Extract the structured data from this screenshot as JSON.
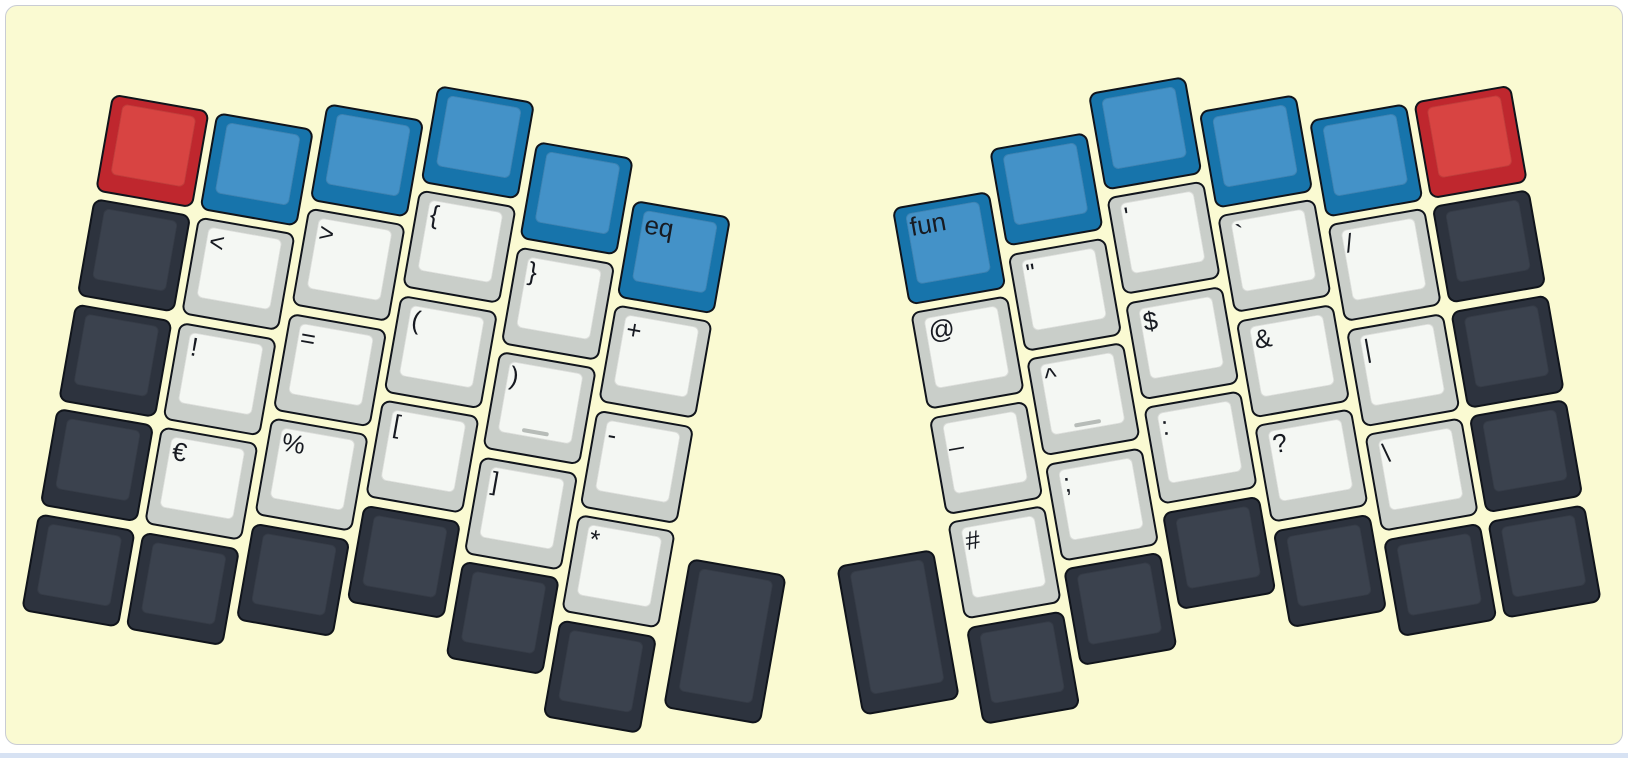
{
  "page": {
    "background": "#ffffff",
    "bottom_strip_color": "#d7e2f3"
  },
  "canvas": {
    "background": "#fafad2",
    "border_color": "#c9ccd4"
  },
  "palette": {
    "outline": "#10141b",
    "legend": "#171a21",
    "homing_bar": "#b7bcb8",
    "red": {
      "side": "#bf272e",
      "top": "#d84442"
    },
    "blue": {
      "side": "#1774ab",
      "top": "#4492c8"
    },
    "dark": {
      "side": "#2d333e",
      "top": "#3b424e"
    },
    "light": {
      "side": "#c9cec9",
      "top": "#f4f7f3"
    }
  },
  "geometry": {
    "unit_px": 106.5,
    "key_size_px": 99,
    "key_inset_px": 3.75
  },
  "halves": {
    "left": {
      "name": "left-hand",
      "rotation_deg": 10,
      "origin": {
        "x": 103,
        "y": 83
      },
      "mirrored": false,
      "columns": [
        {
          "stagger_px": 0,
          "keys": [
            {
              "color": "red",
              "label": ""
            },
            {
              "color": "dark",
              "label": ""
            },
            {
              "color": "dark",
              "label": ""
            },
            {
              "color": "dark",
              "label": ""
            },
            {
              "color": "dark",
              "label": ""
            }
          ]
        },
        {
          "stagger_px": 0,
          "keys": [
            {
              "color": "blue",
              "label": ""
            },
            {
              "color": "light",
              "label": "<"
            },
            {
              "color": "light",
              "label": "!"
            },
            {
              "color": "light",
              "label": "€"
            },
            {
              "color": "dark",
              "label": ""
            }
          ]
        },
        {
          "stagger_px": -28,
          "keys": [
            {
              "color": "blue",
              "label": ""
            },
            {
              "color": "light",
              "label": ">"
            },
            {
              "color": "light",
              "label": "="
            },
            {
              "color": "light",
              "label": "%"
            },
            {
              "color": "dark",
              "label": ""
            }
          ]
        },
        {
          "stagger_px": -65,
          "keys": [
            {
              "color": "blue",
              "label": ""
            },
            {
              "color": "light",
              "label": "{"
            },
            {
              "color": "light",
              "label": "("
            },
            {
              "color": "light",
              "label": "["
            },
            {
              "color": "dark",
              "label": ""
            }
          ]
        },
        {
          "stagger_px": -26.5,
          "keys": [
            {
              "color": "blue",
              "label": ""
            },
            {
              "color": "light",
              "label": "}"
            },
            {
              "color": "light",
              "label": ")",
              "homing": true
            },
            {
              "color": "light",
              "label": "]"
            },
            {
              "color": "dark",
              "label": ""
            }
          ]
        },
        {
          "stagger_px": 14,
          "keys": [
            {
              "color": "blue",
              "label": "eq"
            },
            {
              "color": "light",
              "label": "+"
            },
            {
              "color": "light",
              "label": "-"
            },
            {
              "color": "light",
              "label": "*"
            },
            {
              "color": "dark",
              "label": ""
            }
          ]
        }
      ],
      "thumb": {
        "color": "dark",
        "label": "",
        "x_px": 653,
        "y_px": 361,
        "w_px": 99,
        "h_px": 152
      }
    },
    "right": {
      "name": "right-hand",
      "rotation_deg": -10,
      "origin": {
        "x": 1508,
        "y": 74
      },
      "mirrored": true,
      "columns": [
        {
          "stagger_px": 0,
          "keys": [
            {
              "color": "red",
              "label": ""
            },
            {
              "color": "dark",
              "label": ""
            },
            {
              "color": "dark",
              "label": ""
            },
            {
              "color": "dark",
              "label": ""
            },
            {
              "color": "dark",
              "label": ""
            }
          ]
        },
        {
          "stagger_px": 0,
          "keys": [
            {
              "color": "blue",
              "label": ""
            },
            {
              "color": "light",
              "label": "/"
            },
            {
              "color": "light",
              "label": "|"
            },
            {
              "color": "light",
              "label": "\\"
            },
            {
              "color": "dark",
              "label": ""
            }
          ]
        },
        {
          "stagger_px": -28,
          "keys": [
            {
              "color": "blue",
              "label": ""
            },
            {
              "color": "light",
              "label": "`"
            },
            {
              "color": "light",
              "label": "&"
            },
            {
              "color": "light",
              "label": "?"
            },
            {
              "color": "dark",
              "label": ""
            }
          ]
        },
        {
          "stagger_px": -65,
          "keys": [
            {
              "color": "blue",
              "label": ""
            },
            {
              "color": "light",
              "label": "'"
            },
            {
              "color": "light",
              "label": "$"
            },
            {
              "color": "light",
              "label": ":"
            },
            {
              "color": "dark",
              "label": ""
            }
          ]
        },
        {
          "stagger_px": -26.5,
          "keys": [
            {
              "color": "blue",
              "label": ""
            },
            {
              "color": "light",
              "label": "\""
            },
            {
              "color": "light",
              "label": "^",
              "homing": true
            },
            {
              "color": "light",
              "label": ";"
            },
            {
              "color": "dark",
              "label": ""
            }
          ]
        },
        {
          "stagger_px": 14,
          "keys": [
            {
              "color": "blue",
              "label": "fun"
            },
            {
              "color": "light",
              "label": "@"
            },
            {
              "color": "light",
              "label": "_"
            },
            {
              "color": "light",
              "label": "#"
            },
            {
              "color": "dark",
              "label": ""
            }
          ]
        }
      ],
      "thumb": {
        "color": "dark",
        "label": "",
        "x_px": -752,
        "y_px": 361,
        "w_px": 99,
        "h_px": 152
      }
    }
  }
}
